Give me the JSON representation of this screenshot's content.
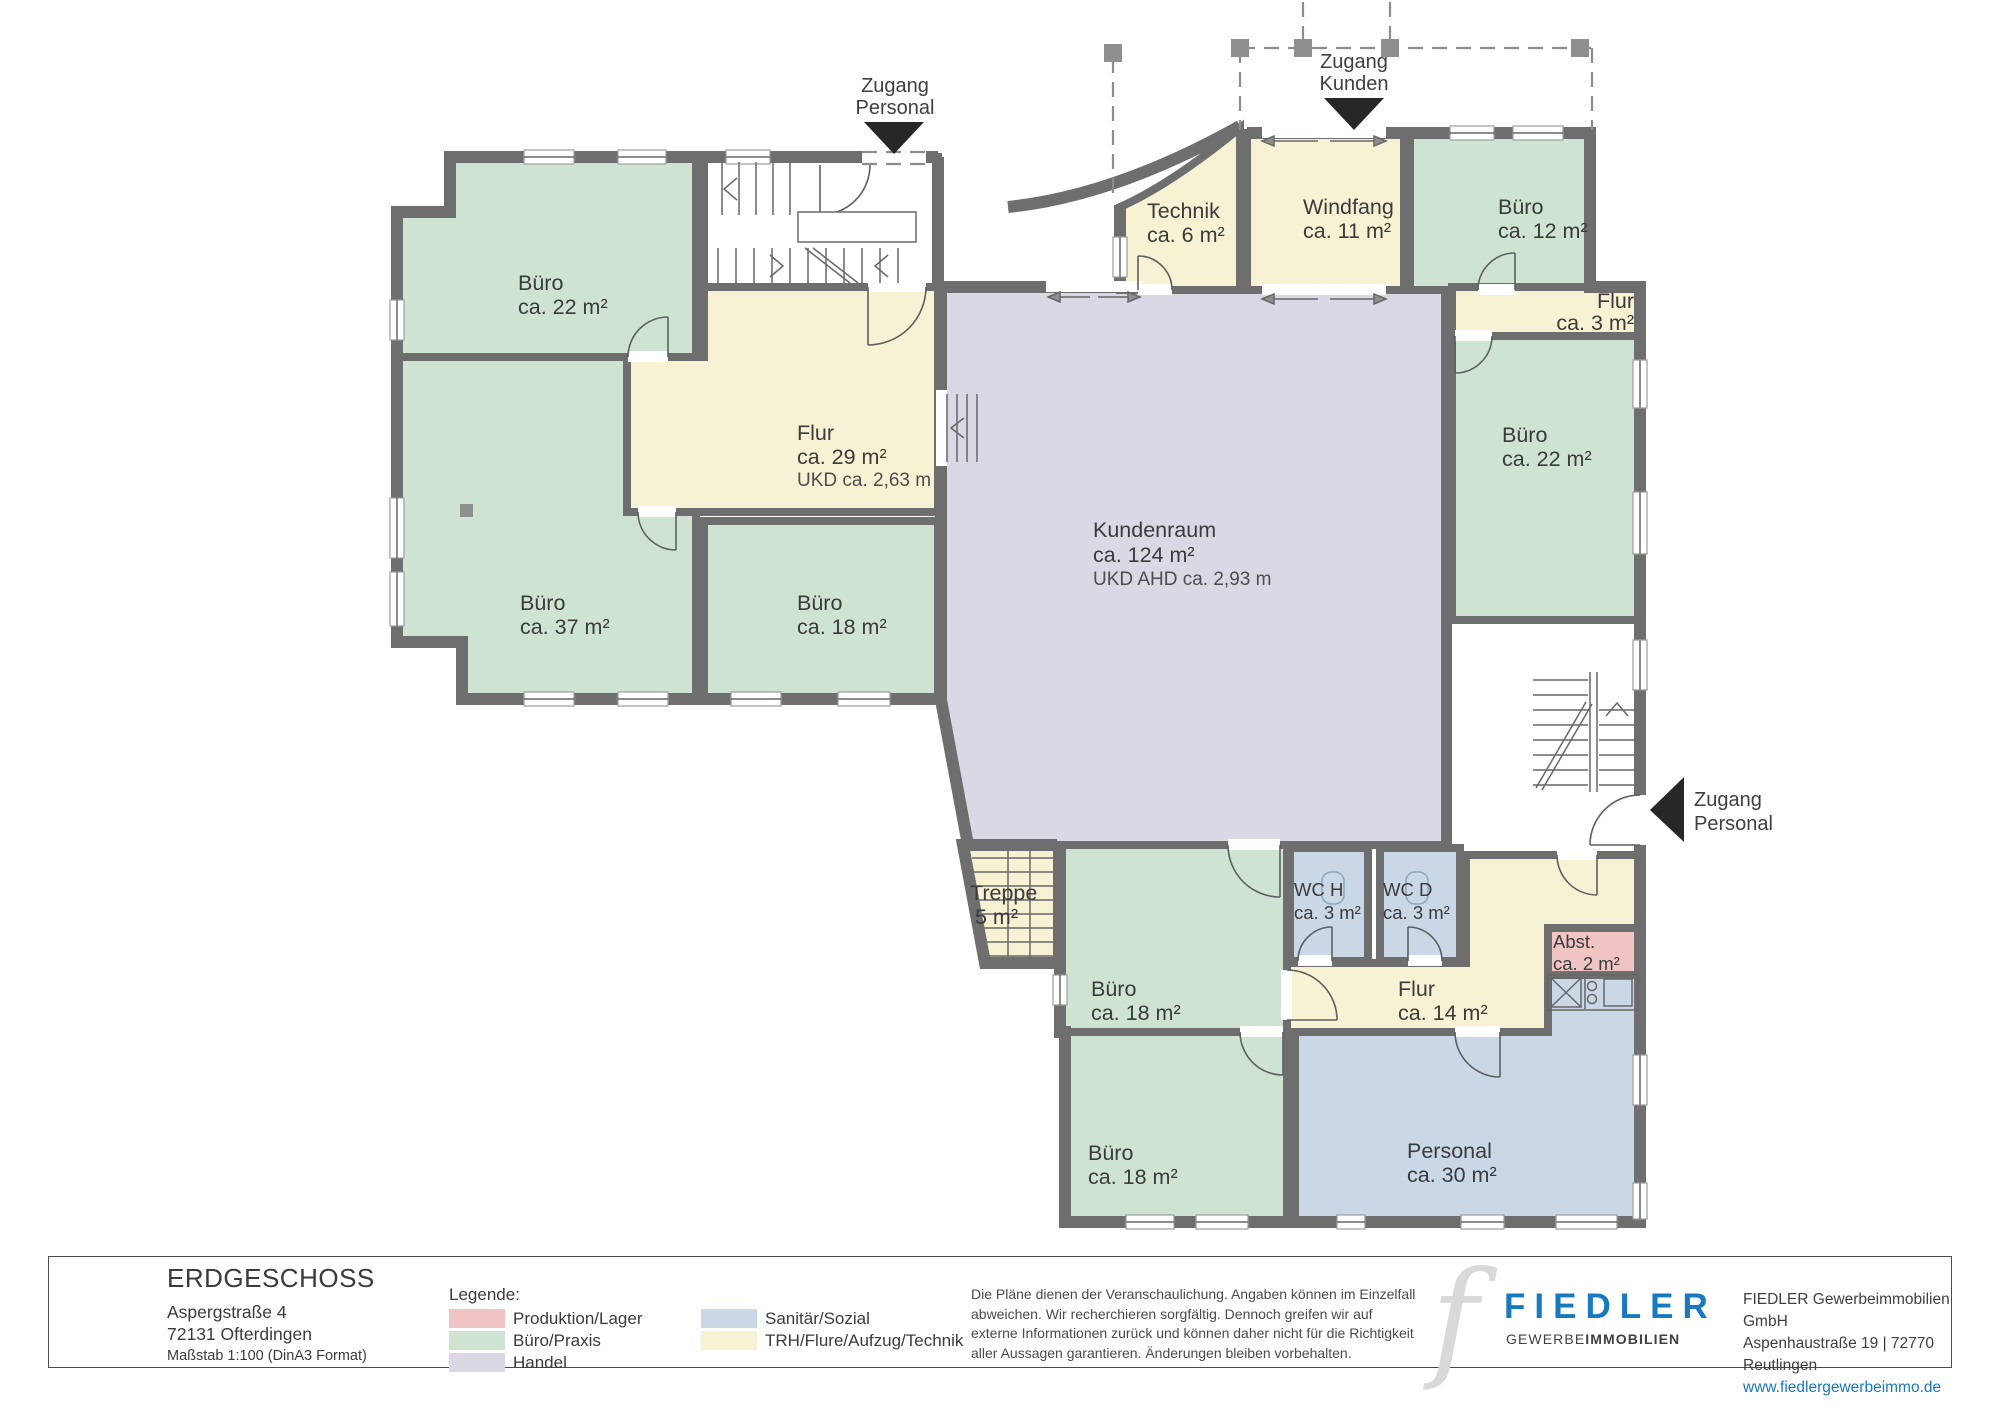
{
  "entrances": {
    "top_left": {
      "line1": "Zugang",
      "line2": "Personal"
    },
    "top_center": {
      "line1": "Zugang",
      "line2": "Kunden"
    },
    "right": {
      "line1": "Zugang",
      "line2": "Personal"
    }
  },
  "rooms": {
    "buero22l": {
      "name": "Büro",
      "area": "ca. 22 m²"
    },
    "buero37": {
      "name": "Büro",
      "area": "ca. 37 m²"
    },
    "flur29": {
      "name": "Flur",
      "area": "ca. 29 m²",
      "note": "UKD ca. 2,63 m"
    },
    "buero18l": {
      "name": "Büro",
      "area": "ca. 18 m²"
    },
    "kundenraum": {
      "name": "Kundenraum",
      "area": "ca. 124 m²",
      "note": "UKD AHD ca. 2,93 m"
    },
    "technik": {
      "name": "Technik",
      "area": "ca. 6 m²"
    },
    "windfang": {
      "name": "Windfang",
      "area": "ca. 11 m²"
    },
    "buero12": {
      "name": "Büro",
      "area": "ca. 12 m²"
    },
    "flur3": {
      "name": "Flur",
      "area": "ca. 3 m²"
    },
    "buero22r": {
      "name": "Büro",
      "area": "ca. 22 m²"
    },
    "treppe": {
      "name": "Treppe",
      "area": "5 m²"
    },
    "buero18m": {
      "name": "Büro",
      "area": "ca. 18 m²"
    },
    "wch": {
      "name": "WC H",
      "area": "ca. 3 m²"
    },
    "wcd": {
      "name": "WC D",
      "area": "ca. 3 m²"
    },
    "flur14": {
      "name": "Flur",
      "area": "ca. 14 m²"
    },
    "abst": {
      "name": "Abst.",
      "area": "ca. 2 m²"
    },
    "buero18b": {
      "name": "Büro",
      "area": "ca. 18 m²"
    },
    "personal": {
      "name": "Personal",
      "area": "ca. 30 m²"
    }
  },
  "legend": {
    "title": "Legende:",
    "items": [
      {
        "label": "Produktion/Lager"
      },
      {
        "label": "Büro/Praxis"
      },
      {
        "label": "Handel"
      },
      {
        "label": "Sanitär/Sozial"
      },
      {
        "label": "TRH/Flure/Aufzug/Technik"
      }
    ]
  },
  "colors": {
    "produktion_lager": "#f0c4c3",
    "buero_praxis": "#cfe3d2",
    "handel": "#dcd7e5",
    "sanitaer_sozial": "#c9d7e6",
    "trh_flure": "#f7f2d4",
    "wall": "#6e6e6e",
    "brand_blue": "#1779c0"
  },
  "footer": {
    "floor_title": "ERDGESCHOSS",
    "address_line1": "Aspergstraße 4",
    "address_line2": "72131 Ofterdingen",
    "scale": "Maßstab 1:100 (DinA3 Format)",
    "disclaimer_line1": "Die Pläne dienen der Veranschaulichung. Angaben können im Einzelfall",
    "disclaimer_line2": "abweichen. Wir recherchieren sorgfältig. Dennoch greifen wir auf",
    "disclaimer_line3": "externe Informationen zurück und können daher nicht für die Richtigkeit",
    "disclaimer_line4": "aller Aussagen garantieren. Änderungen bleiben vorbehalten."
  },
  "brand": {
    "glyph": "f",
    "name": "FIEDLER",
    "subtitle_normal": "GEWERBE",
    "subtitle_bold": "IMMOBILIEN",
    "company": "FIEDLER Gewerbeimmobilien GmbH",
    "street": "Aspenhaustraße 19 | 72770 Reutlingen",
    "website": "www.fiedlergewerbeimmo.de"
  }
}
